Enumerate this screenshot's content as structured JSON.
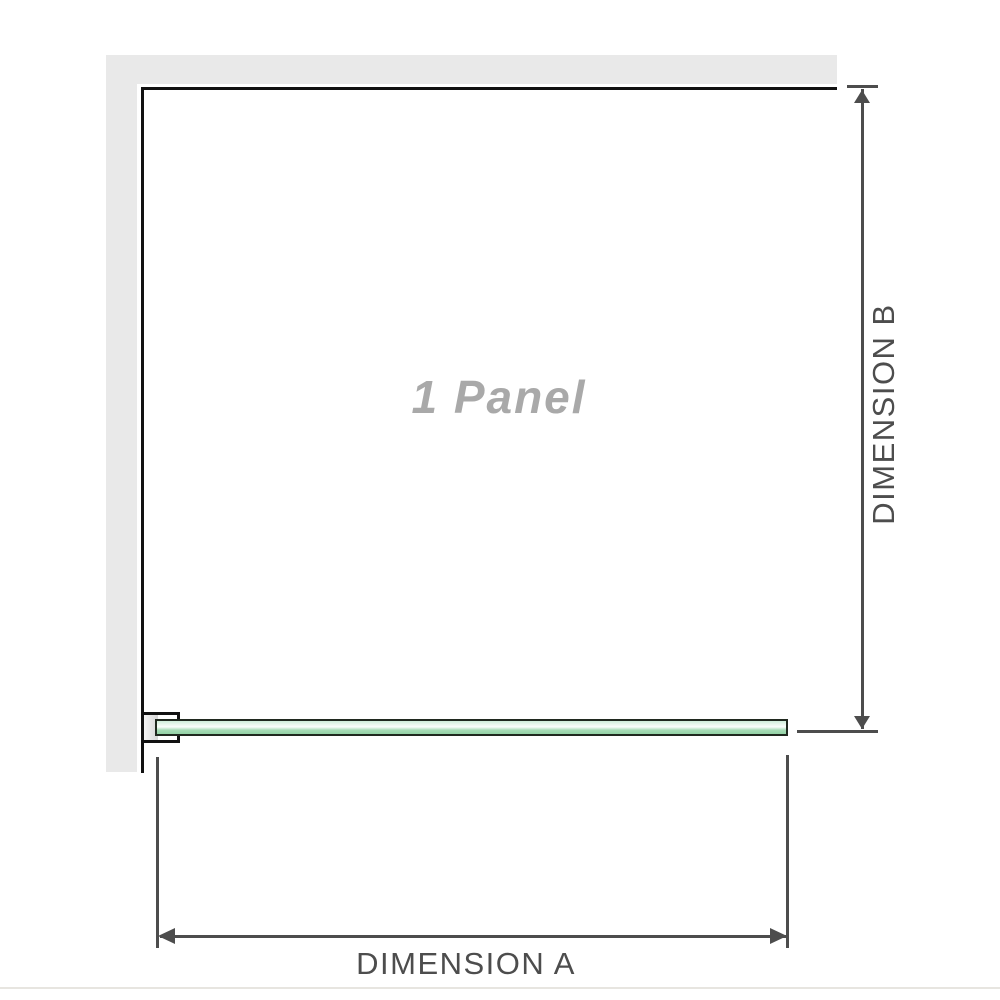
{
  "diagram": {
    "panel_label": "1 Panel",
    "dimension_a_label": "DIMENSION A",
    "dimension_b_label": "DIMENSION B"
  },
  "icons": {
    "arrowhead-up-icon": "css-triangle-up",
    "arrowhead-down-icon": "css-triangle-down",
    "arrowhead-left-icon": "css-triangle-left",
    "arrowhead-right-icon": "css-triangle-right"
  },
  "colors": {
    "wall": "#e9e9e9",
    "panel_border": "#111111",
    "glass_border": "#20291f",
    "glass_light": "#eef9f1",
    "glass_mid": "#a7dcb6",
    "glass_deep": "#93d2a5",
    "dimension": "#4d4d4d",
    "panel_text": "#a9a9a9",
    "divider": "#e7e5e0",
    "bracket_channel_light": "#f4f4f4",
    "bracket_channel_dark": "#d6d6d6"
  }
}
